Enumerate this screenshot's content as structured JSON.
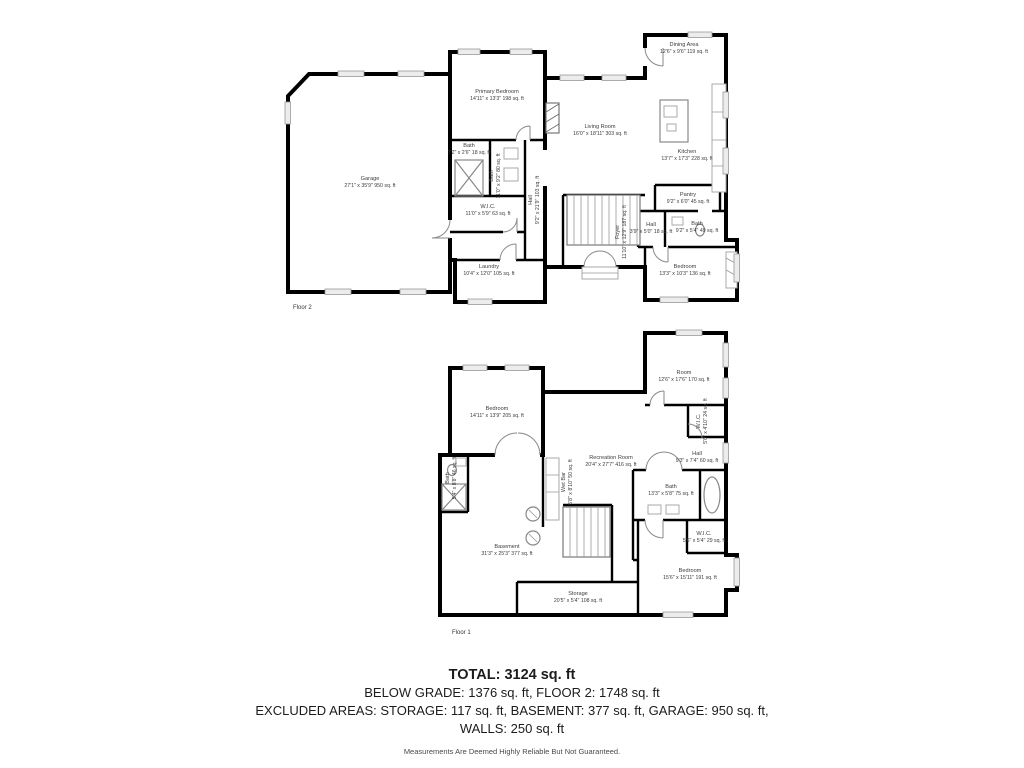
{
  "colors": {
    "wall": "#000000",
    "label_text": "#3c3c3c",
    "summary_text": "#1c1c1c",
    "fixture": "#999999"
  },
  "floor2": {
    "caption": "Floor 2",
    "rooms": {
      "garage": {
        "name": "Garage",
        "dims": "27'1\" x 35'9\" 950 sq. ft"
      },
      "primary_bedroom": {
        "name": "Primary Bedroom",
        "dims": "14'11\" x 13'3\" 198 sq. ft"
      },
      "bath_small": {
        "name": "Bath",
        "dims": "7'2\" x 2'6\" 18 sq. ft"
      },
      "bath_main": {
        "name": "Bath",
        "dims": "11'0\" x 9'2\" 80 sq. ft"
      },
      "wic": {
        "name": "W.I.C.",
        "dims": "11'0\" x 5'9\" 63 sq. ft"
      },
      "hall": {
        "name": "Hall",
        "dims": "9'2\" x 21'9\" 103 sq. ft"
      },
      "laundry": {
        "name": "Laundry",
        "dims": "10'4\" x 12'0\" 105 sq. ft"
      },
      "living_room": {
        "name": "Living Room",
        "dims": "16'0\" x 18'11\" 303 sq. ft"
      },
      "dining_area": {
        "name": "Dining Area",
        "dims": "12'6\" x 9'6\" 119 sq. ft"
      },
      "kitchen": {
        "name": "Kitchen",
        "dims": "13'7\" x 17'3\" 228 sq. ft"
      },
      "pantry": {
        "name": "Pantry",
        "dims": "9'2\" x 6'0\" 45 sq. ft"
      },
      "hall_small": {
        "name": "Hall",
        "dims": "3'9\" x 5'0\" 18 sq. ft"
      },
      "bath_right": {
        "name": "Bath",
        "dims": "9'2\" x 5'4\" 49 sq. ft"
      },
      "foyer": {
        "name": "Foyer",
        "dims": "11'10\" x 12'9\" 187 sq. ft"
      },
      "bedroom": {
        "name": "Bedroom",
        "dims": "13'3\" x 10'3\" 136 sq. ft"
      }
    }
  },
  "floor1": {
    "caption": "Floor 1",
    "rooms": {
      "bedroom_left": {
        "name": "Bedroom",
        "dims": "14'11\" x 13'9\" 205 sq. ft"
      },
      "room": {
        "name": "Room",
        "dims": "12'6\" x 17'6\" 170 sq. ft"
      },
      "wic_top": {
        "name": "W.I.C.",
        "dims": "5'0\" x 4'10\" 24 sq. ft"
      },
      "hall": {
        "name": "Hall",
        "dims": "9'3\" x 7'4\" 60 sq. ft"
      },
      "recreation": {
        "name": "Recreation Room",
        "dims": "20'4\" x 27'7\" 416 sq. ft"
      },
      "wet_bar": {
        "name": "Wet Bar",
        "dims": "5'8\" x 8'10\" 50 sq. ft"
      },
      "bath_left": {
        "name": "Bath",
        "dims": "5'4\" x 8'8\" 46 sq. ft"
      },
      "bath_right": {
        "name": "Bath",
        "dims": "13'3\" x 5'8\" 75 sq. ft"
      },
      "wic_right": {
        "name": "W.I.C.",
        "dims": "5'6\" x 5'4\" 29 sq. ft"
      },
      "bedroom_right": {
        "name": "Bedroom",
        "dims": "15'6\" x 15'11\" 191 sq. ft"
      },
      "basement": {
        "name": "Basement",
        "dims": "31'3\" x 25'3\" 377 sq. ft"
      },
      "storage": {
        "name": "Storage",
        "dims": "20'5\" x 5'4\" 108 sq. ft"
      }
    }
  },
  "summary": {
    "total": "TOTAL: 3124 sq. ft",
    "line2": "BELOW GRADE: 1376 sq. ft, FLOOR 2: 1748 sq. ft",
    "line3": "EXCLUDED AREAS: STORAGE: 117 sq. ft, BASEMENT: 377 sq. ft, GARAGE: 950 sq. ft,",
    "line4": "WALLS: 250 sq. ft",
    "disclaimer": "Measurements Are Deemed Highly Reliable But Not Guaranteed."
  }
}
